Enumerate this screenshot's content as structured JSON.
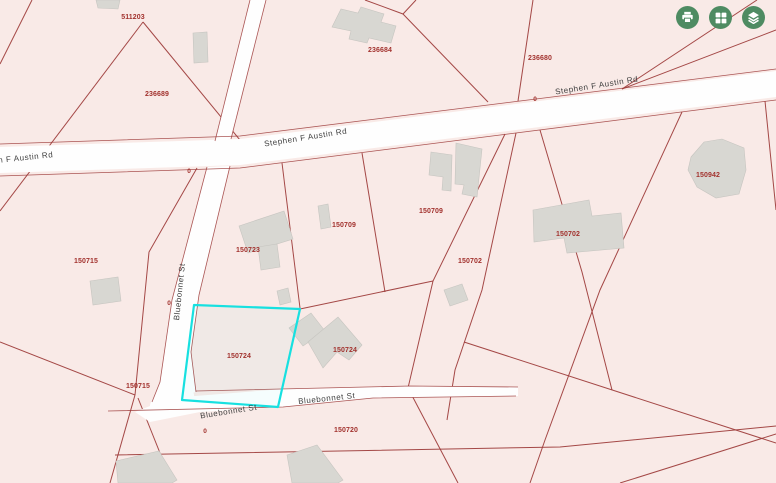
{
  "app": {
    "title": "Parcel map viewer"
  },
  "colors": {
    "parcel_fill": "#f9eae7",
    "parcel_line": "#9c3a38",
    "road_fill": "#fefefe",
    "building_fill": "#d8d7d2",
    "building_stroke": "#c6c5c0",
    "highlight": "#17e0e0",
    "parcel_label": "#a2322e",
    "road_label": "#3d3d3d",
    "button_green": "#4e8b62",
    "button_icon": "#ffffff"
  },
  "toolbar": {
    "buttons": [
      {
        "name": "print-button",
        "icon": "printer-icon"
      },
      {
        "name": "basemap-grid-button",
        "icon": "grid-icon"
      },
      {
        "name": "layers-button",
        "icon": "layers-icon"
      }
    ]
  },
  "map": {
    "roads": [
      {
        "name": "stephen-f-austin-rd",
        "points": "0,147 240,139 776,71 776,97 240,165 0,173"
      },
      {
        "name": "bluebonnet-st-upper",
        "points": "250,0 266,0 231,139 215,141"
      },
      {
        "name": "bluebonnet-st-lower",
        "points": "230,166 199,295 191,352 196,392 152,402 160,382 172,300 207,167"
      },
      {
        "name": "bluebonnet-st-bottom",
        "points": "170,398 283,389 410,386 518,387 518,396 373,398 283,407 200,412 150,422 135,412"
      }
    ],
    "road_junction": {
      "cx": 172,
      "cy": 401,
      "rx": 23,
      "ry": 13,
      "rot": -20
    },
    "parcel_lines": [
      "143,22 0,211",
      "143,22 249,151",
      "32,0 0,64",
      "365,0 403,14 416,0",
      "403,14 488,102",
      "533,0 518,101",
      "757,0 622,89",
      "776,30 622,89",
      "197,168 149,252 135,395",
      "0,342 135,395",
      "135,395 110,483",
      "138,398 172,483",
      "408,388 458,483",
      "115,455 560,447 776,426",
      "620,483 776,434",
      "505,134 433,281 408,388",
      "516,133 482,290 455,370 447,420",
      "540,130 582,272 612,390",
      "464,342 776,443",
      "682,112 600,290 545,440 530,483",
      "765,101 776,210",
      "282,163 300,308",
      "362,153 385,292",
      "300,309 433,281"
    ],
    "road_edge_lines": [
      "0,144 240,136 776,69",
      "0,176 240,168 776,100",
      "250,0 215,141",
      "266,0 231,139",
      "207,167 172,300 160,382 152,402",
      "230,166 199,295 191,352 196,392",
      "108,411 283,407 373,398 516,396",
      "196,391 410,386 518,387"
    ],
    "buildings": [
      "193,33 207,32 208,62 194,63",
      "332,27 341,9 358,13 361,7 384,14 381,22 396,26 391,43 369,38 367,43 349,39 351,31",
      "96,0 120,0 118,9 98,8",
      "691,157 704,142 722,139 744,148 746,170 739,194 716,198 697,187 688,170",
      "431,152 452,155 451,191 442,190 443,177 429,175",
      "456,143 482,149 477,197 462,194 464,185 455,184",
      "533,210 589,200 592,216 621,213 624,248 567,253 564,238 534,242",
      "444,290 462,284 468,300 450,306",
      "239,226 284,211 293,239 248,253",
      "258,247 277,244 280,267 261,270",
      "318,206 328,204 331,227 321,229",
      "277,291 288,288 291,302 280,305",
      "289,328 311,313 325,331 303,346",
      "308,342 338,317 362,345 349,360 337,352 323,368",
      "116,461 159,451 177,480 172,483 118,483",
      "287,455 317,445 343,480 338,483 292,483",
      "90,281 118,277 121,301 93,305"
    ],
    "highlight": {
      "parcel_id": "150724",
      "points": "194,305 300,309 278,407 182,400"
    },
    "parcel_labels": [
      {
        "text": "511203",
        "x": 133,
        "y": 19
      },
      {
        "text": "236689",
        "x": 157,
        "y": 96
      },
      {
        "text": "236684",
        "x": 380,
        "y": 52
      },
      {
        "text": "236680",
        "x": 540,
        "y": 60
      },
      {
        "text": "150942",
        "x": 708,
        "y": 177
      },
      {
        "text": "150709",
        "x": 344,
        "y": 227
      },
      {
        "text": "150709",
        "x": 431,
        "y": 213
      },
      {
        "text": "150723",
        "x": 248,
        "y": 252
      },
      {
        "text": "150702",
        "x": 470,
        "y": 263
      },
      {
        "text": "150702",
        "x": 568,
        "y": 236
      },
      {
        "text": "150715",
        "x": 86,
        "y": 263
      },
      {
        "text": "150715",
        "x": 138,
        "y": 388
      },
      {
        "text": "150724",
        "x": 239,
        "y": 358
      },
      {
        "text": "150724",
        "x": 345,
        "y": 352
      },
      {
        "text": "150720",
        "x": 346,
        "y": 432
      }
    ],
    "road_labels": [
      {
        "text": "Stephen F Austin Rd",
        "x": 306,
        "y": 140,
        "rot": -9
      },
      {
        "text": "Stephen F Austin Rd",
        "x": 597,
        "y": 88,
        "rot": -9
      },
      {
        "text": "n F Austin Rd",
        "x": 26,
        "y": 160,
        "rot": -6
      },
      {
        "text": "Bluebonnet St",
        "x": 182,
        "y": 292,
        "rot": -84
      },
      {
        "text": "Bluebonnet St",
        "x": 229,
        "y": 414,
        "rot": -9
      },
      {
        "text": "Bluebonnet St",
        "x": 327,
        "y": 401,
        "rot": -6
      }
    ],
    "zero_markers": [
      {
        "x": 189,
        "y": 173
      },
      {
        "x": 535,
        "y": 101
      },
      {
        "x": 169,
        "y": 305
      },
      {
        "x": 205,
        "y": 433
      }
    ]
  }
}
